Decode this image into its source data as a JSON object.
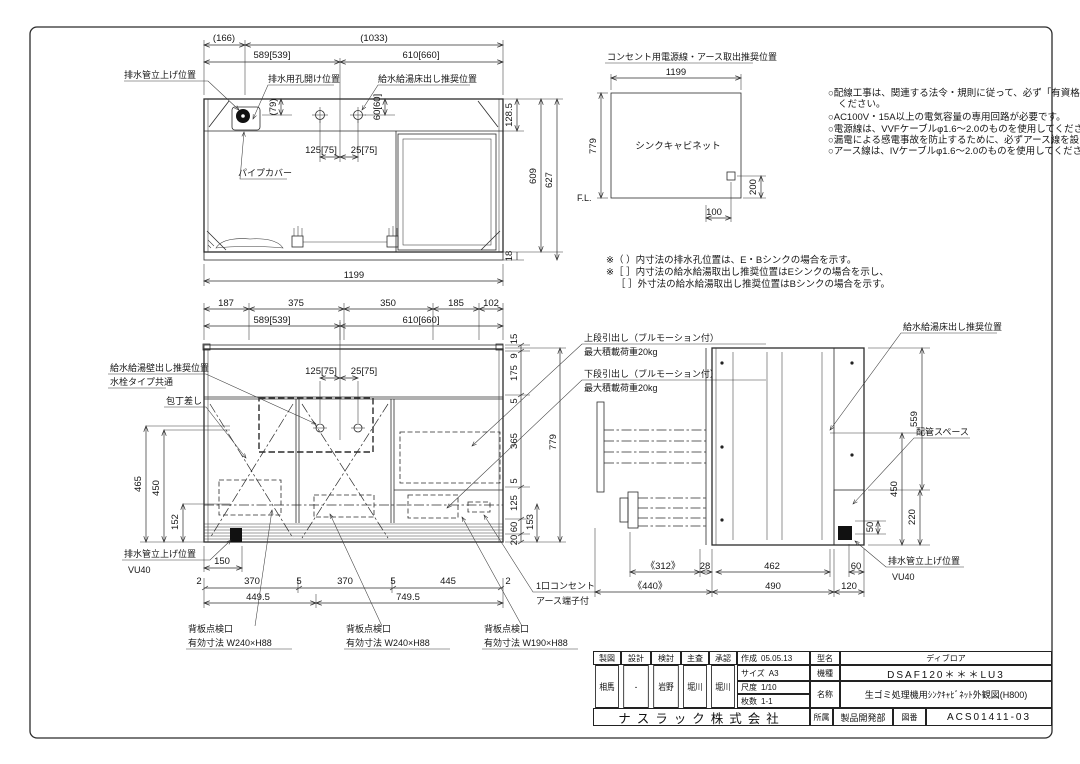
{
  "plan": {
    "labels": {
      "drain_riser": "排水管立上げ位置",
      "drain_hole": "排水用孔開け位置",
      "supply_floor": "給水給湯床出し推奨位置",
      "pipe_cover": "パイプカバー"
    },
    "dims": {
      "d166": "(166)",
      "d1033": "(1033)",
      "d589": "589[539]",
      "d610": "610[660]",
      "d79": "(79)",
      "d60": "60[60]",
      "d125": "125[75]",
      "d25": "25[75]",
      "d1285": "128.5",
      "d609": "609",
      "d627": "627",
      "d18": "18",
      "d1199": "1199"
    }
  },
  "outlet": {
    "title": "コンセント用電源線・アース取出推奨位置",
    "cabinet": "シンクキャビネット",
    "fl": "F.L.",
    "dims": {
      "w": "1199",
      "h": "779",
      "dy": "200",
      "dx": "100"
    },
    "notes": [
      "○配線工事は、関連する法令・規則に従って、必ず「有資格者」が行なって",
      "ください。",
      "○AC100V・15A以上の電気容量の専用回路が必要です。",
      "○電源線は、VVFケーブルφ1.6～2.0のものを使用してください。",
      "○漏電による感電事故を防止するために、必ずアース線を設けてください。",
      "○アース線は、IVケーブルφ1.6～2.0のものを使用してください。"
    ]
  },
  "bracket_notes": [
    "※（ ）内寸法の排水孔位置は、E・Bシンクの場合を示す。",
    "※［ ］内寸法の給水給湯取出し推奨位置はEシンクの場合を示し、",
    "［ ］外寸法の給水給湯取出し推奨位置はBシンクの場合を示す。"
  ],
  "front": {
    "labels": {
      "supply_wall": "給水給湯壁出し推奨位置",
      "faucet_common": "水栓タイプ共通",
      "knife": "包丁差し",
      "upper_drawer": "上段引出し（ブルモーション付）",
      "upper_load": "最大積載荷重20kg",
      "lower_drawer": "下段引出し（ブルモーション付）",
      "lower_load": "最大積載荷重20kg",
      "drain_riser": "排水管立上げ位置",
      "vu40": "VU40",
      "outlet1": "1口コンセント",
      "outlet2": "アース端子付",
      "access": "背板点検口",
      "access1_size": "有効寸法 W240×H88",
      "access2_size": "有効寸法 W240×H88",
      "access3_size": "有効寸法 W190×H88"
    },
    "dims": {
      "t187": "187",
      "t375": "375",
      "t350": "350",
      "t185": "185",
      "t102": "102",
      "t589": "589[539]",
      "t610": "610[660]",
      "t125": "125[75]",
      "t25": "25[75]",
      "l465": "465",
      "l450": "450",
      "l152": "152",
      "l150": "150",
      "b2a": "2",
      "b370a": "370",
      "b5a": "5",
      "b370b": "370",
      "b5b": "5",
      "b445": "445",
      "b2b": "2",
      "b4495": "449.5",
      "b7495": "749.5",
      "r15": "15",
      "r9": "9",
      "r175": "175",
      "r5a": "5",
      "r365": "365",
      "r5b": "5",
      "r125": "125",
      "r60": "60",
      "r20": "20",
      "r153": "153",
      "r779": "779"
    }
  },
  "side": {
    "labels": {
      "supply_floor": "給水給湯床出し推奨位置",
      "pipe_space": "配管スペース",
      "drain_riser": "排水管立上げ位置",
      "vu40": "VU40"
    },
    "dims": {
      "d312": "《312》",
      "d28": "28",
      "d462": "462",
      "d60": "60",
      "d440": "《440》",
      "d490": "490",
      "d120": "120",
      "d559": "559",
      "d450": "450",
      "d220": "220",
      "d50": "50"
    }
  },
  "title_block": {
    "sign_headers": [
      "製図",
      "設計",
      "検討",
      "主査",
      "承認"
    ],
    "signatures": [
      "相馬",
      "-",
      "岩野",
      "堀川",
      "堀川"
    ],
    "created_label": "作成",
    "created": "05.05.13",
    "size_label": "サイズ",
    "size": "A3",
    "scale_label": "尺度",
    "scale": "1/10",
    "sheets_label": "枚数",
    "sheets": "1-1",
    "model_label": "型名",
    "model": "ディブロア",
    "machine_label": "機種",
    "machine": "DSAF120＊＊＊LU3",
    "name_label": "名称",
    "name": "生ゴミ処理機用ｼﾝｸｷｬﾋﾞﾈｯﾄ外観図(H800)",
    "company": "ナスラック株式会社",
    "dept_label": "所属",
    "dept": "製品開発部",
    "dwg_label": "図番",
    "dwg_no": "ACS01411-03"
  }
}
